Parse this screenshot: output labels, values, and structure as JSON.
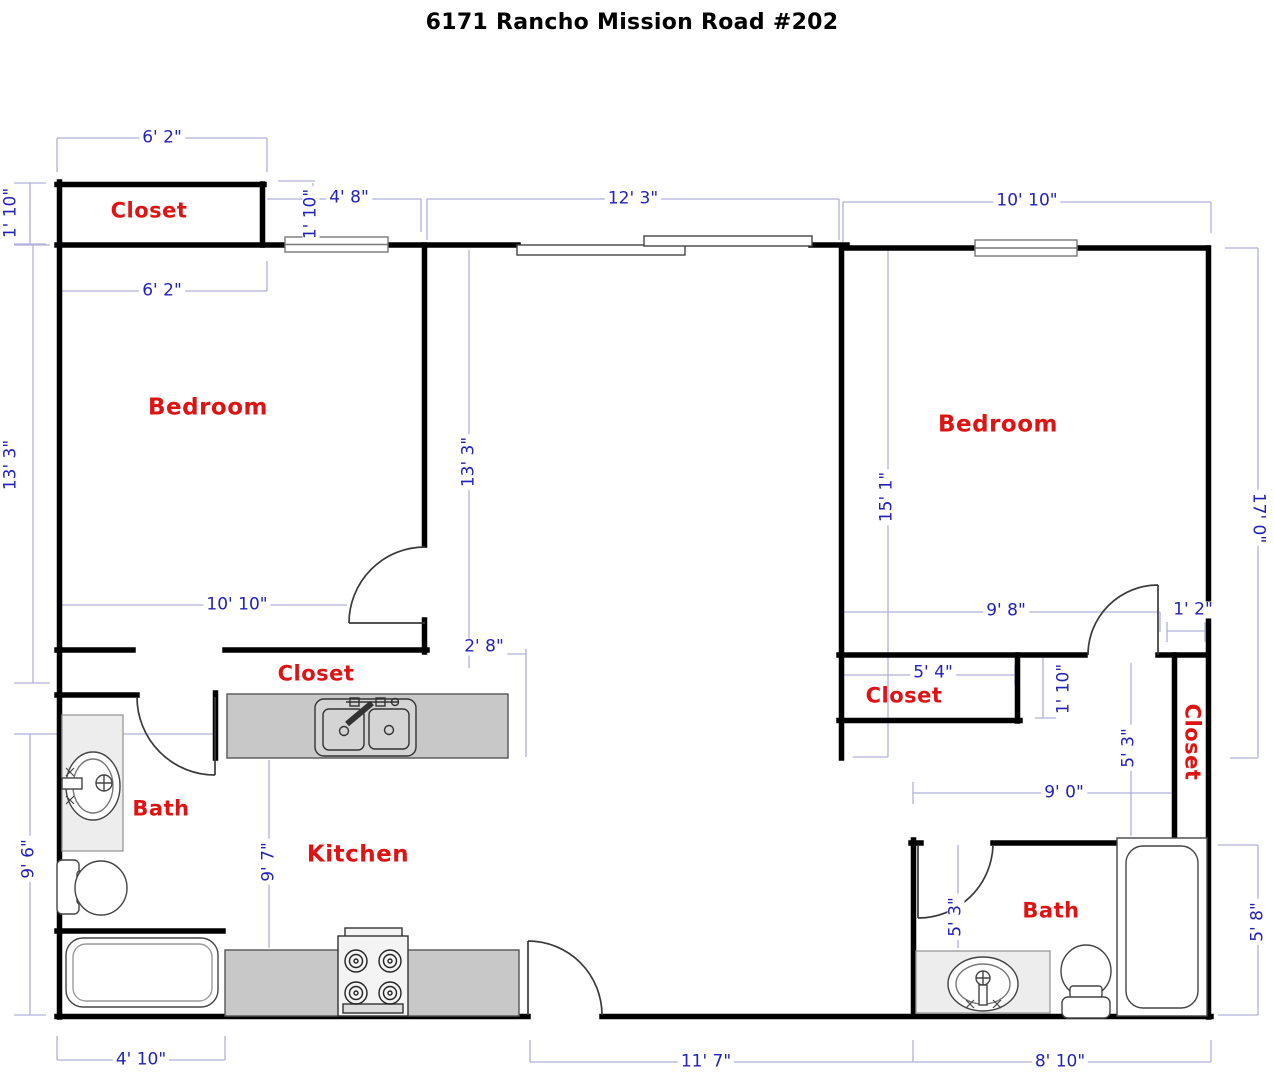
{
  "title": "6171 Rancho Mission Road #202",
  "rooms": {
    "closet_top_left": "Closet",
    "bedroom_left": "Bedroom",
    "closet_middle": "Closet",
    "bath_left": "Bath",
    "kitchen": "Kitchen",
    "bedroom_right": "Bedroom",
    "closet_right": "Closet",
    "closet_right_column": "Closet",
    "bath_right": "Bath"
  },
  "dimensions": {
    "closet_tl_width_top": "6' 2\"",
    "closet_tl_depth": "1' 10\"",
    "entry_nook_width": "4' 8\"",
    "entry_nook_depth": "1' 10\"",
    "living_top_width": "12' 3\"",
    "bedroom_right_width_top": "10' 10\"",
    "closet_tl_width_bottom": "6' 2\"",
    "bedroom_left_height_outer": "13' 3\"",
    "bedroom_left_height_inner": "13' 3\"",
    "bedroom_left_width": "10' 10\"",
    "hall_gap": "2' 8\"",
    "kitchen_depth": "9' 7\"",
    "bath_left_height": "9' 6\"",
    "bath_left_width": "4' 10\"",
    "living_bottom_width": "11' 7\"",
    "bath_right_width_bottom": "8' 10\"",
    "bedroom_right_height": "15' 1\"",
    "right_side_height": "17' 0\"",
    "bedroom_right_width_bottom": "9' 8\"",
    "door_offset_right": "1' 2\"",
    "closet_right_width": "5' 4\"",
    "closet_right_depth": "1' 10\"",
    "closet_column_height": "5' 3\"",
    "bath_right_top_width": "9' 0\"",
    "bath_right_door_depth": "5' 3\"",
    "bath_right_height": "5' 8\""
  },
  "colors": {
    "wall": "#000000",
    "dimension_text": "#2222b8",
    "dimension_line": "#b0b0dc",
    "room_label": "#de1414",
    "counter_fill": "#c8c8c8",
    "vanity_fill": "#ededed"
  }
}
